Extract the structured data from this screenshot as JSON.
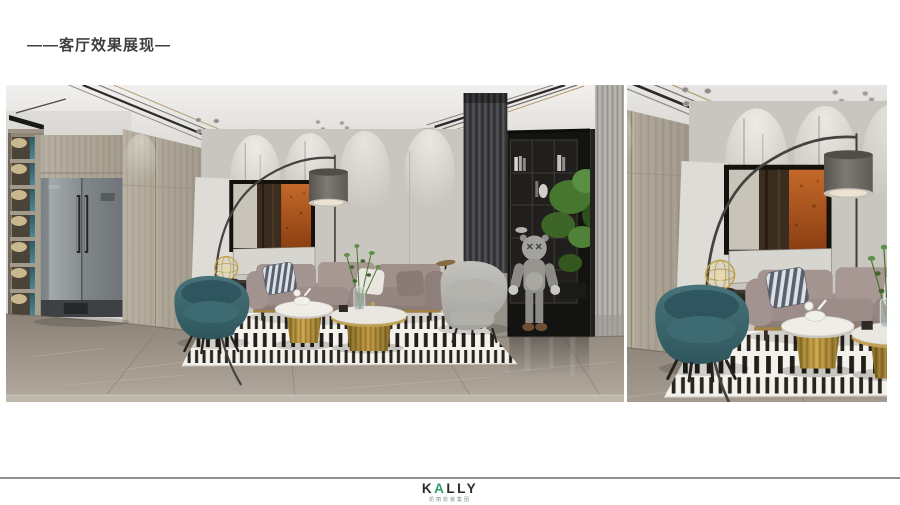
{
  "slide": {
    "background": "#ffffff",
    "title": {
      "text": "——客厅效果展现—",
      "color": "#3f3f3f"
    },
    "gallery": {
      "main_image_label": "客厅效果图 全景视角",
      "detail_image_label": "客厅效果图 局部特写"
    },
    "footer": {
      "divider_color": "#8f8f8f",
      "logo": {
        "prefix": "K",
        "accent_letter": "A",
        "suffix": "LLY",
        "accent_color": "#2f9e68",
        "text_color": "#2b2b2b",
        "subtext": "凯丽软装集团"
      }
    },
    "scene_palette": {
      "wall": "#c9c6c0",
      "wood": "#ada596",
      "sofa": "#998a86",
      "armchair_teal": "#3c6a72",
      "brass": "#b08a33",
      "floor_marble": "#9a9186",
      "rug_stripe": "#28241e",
      "plant": "#4a7a36",
      "artwork_orange": "#b45a1f"
    }
  }
}
